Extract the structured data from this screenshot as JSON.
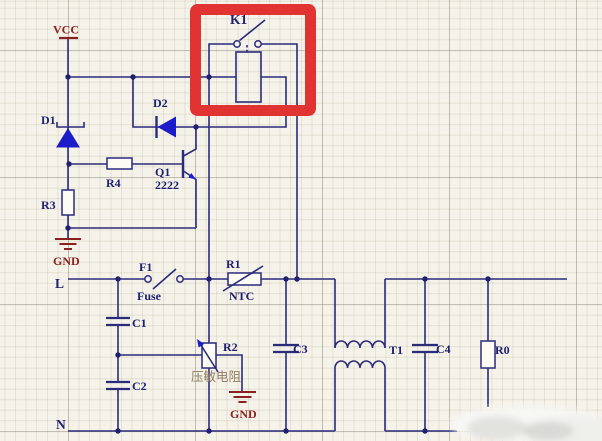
{
  "diagram": {
    "kind": "power-supply circuit schematic",
    "highlighted_component": "K1 relay (marked with red box)"
  },
  "labels": {
    "vcc": "VCC",
    "gnd_upper": "GND",
    "gnd_lower": "GND",
    "relay_ref": "K1",
    "diode1": "D1",
    "diode2": "D2",
    "r4": "R4",
    "q1_ref": "Q1",
    "q1_part": "2222",
    "r3": "R3",
    "fuse_ref": "F1",
    "fuse_name": "Fuse",
    "ntc_ref": "R1",
    "ntc_name": "NTC",
    "varistor_ref": "R2",
    "varistor_name": "压敏电阻",
    "c1": "C1",
    "c2": "C2",
    "c3": "C3",
    "c4": "C4",
    "t1": "T1",
    "r0": "R0",
    "live": "L",
    "neutral": "N"
  },
  "colors": {
    "background": "#f5f2e9",
    "grid_minor": "#e4e1d3",
    "grid_major": "#ccc8ba",
    "wire": "#2b2b7c",
    "label": "#20206e",
    "power_label": "#8a2121",
    "diode_fill": "#1c1cc8",
    "highlight_box": "#e23333",
    "varistor_label_color": "#8f7b60",
    "component_fill": "#fcfbf4"
  }
}
